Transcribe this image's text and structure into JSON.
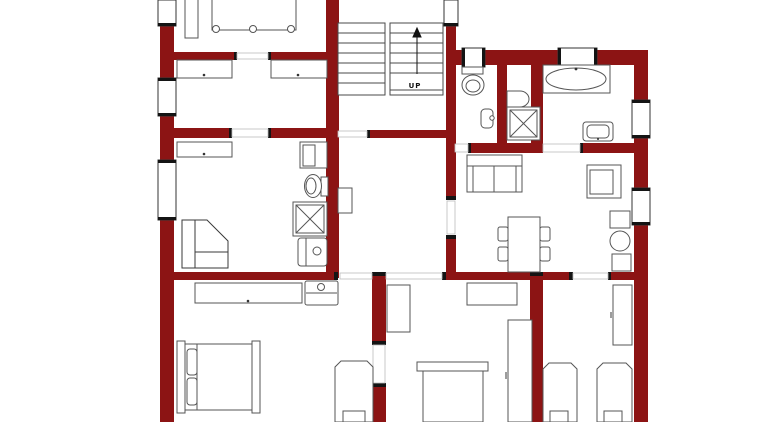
{
  "plan": {
    "stairs_label": "UP",
    "colors": {
      "wall": "#8c1414",
      "outline": "#555555",
      "cap": "#141414",
      "window_frame": "#333333",
      "background": "#ffffff"
    },
    "fixtures": [
      "staircase-up",
      "bathtub",
      "shower-stall",
      "toilet",
      "wall-sink",
      "vanity-sink",
      "washer-cabinet",
      "double-bed",
      "single-bed",
      "wardrobe",
      "dresser",
      "nightstand",
      "corner-desk",
      "sofa",
      "armchair",
      "dining-table",
      "dining-chair",
      "side-table",
      "plant"
    ]
  }
}
